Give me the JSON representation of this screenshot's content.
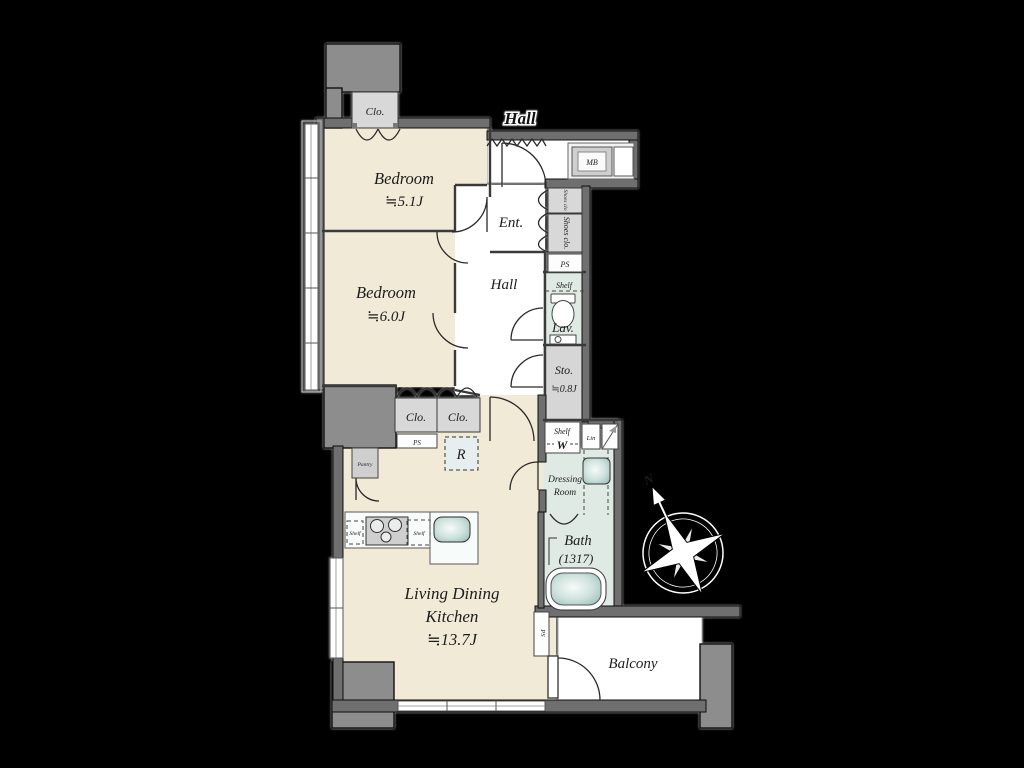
{
  "plan": {
    "corridor_label": "Hall",
    "rooms": {
      "bedroom1_name": "Bedroom",
      "bedroom1_size": "≒5.1J",
      "bedroom2_name": "Bedroom",
      "bedroom2_size": "≒6.0J",
      "ldk_line1": "Living Dining",
      "ldk_line2": "Kitchen",
      "ldk_size": "≒13.7J",
      "entrance": "Ent.",
      "hall": "Hall",
      "lavatory": "Lav.",
      "storage_name": "Sto.",
      "storage_size": "≒0.8J",
      "bath_name": "Bath",
      "bath_size": "(1317)",
      "dressing_line1": "Dressing",
      "dressing_line2": "Room",
      "balcony": "Balcony"
    },
    "fixtures": {
      "closet_top": "Clo.",
      "closet_a": "Clo.",
      "closet_b": "Clo.",
      "pantry": "Pantry",
      "shoes_closet_small": "Shoes clo",
      "shoes_closet": "Shoes clo.",
      "ps_entry": "PS",
      "ps_kitchen": "PS",
      "ps_balcony": "PS",
      "shelf_lavatory": "Shelf",
      "shelf_laundry": "Shelf",
      "washer": "W",
      "linen": "Lin",
      "refrigerator": "R",
      "mail_box": "MB",
      "shelf_counter_a": "Shelf",
      "shelf_counter_b": "Shelf"
    },
    "compass": {
      "north": "N"
    },
    "colors": {
      "background": "#000000",
      "floor": "#f1ead7",
      "wet_floor": "#dfeae5",
      "white_floor": "#ffffff",
      "wall": "#6f6f6f",
      "structure": "#8d8d8d",
      "closet": "#d8d8d8",
      "fixture_teal": "#aeccc7"
    }
  }
}
